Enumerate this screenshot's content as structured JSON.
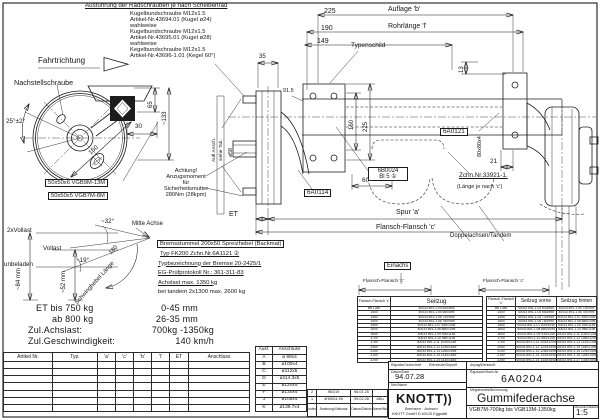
{
  "notes": {
    "title": "Ausführung der Radschrauben je nach Scheibenrad",
    "lines": [
      "Kugelbundschraube M12x1.5",
      "Artikel-Nr.43694.01 (Kugel ø24)",
      "wahlweise",
      "Kugelbundschraube M12x1.5",
      "Artikel-Nr.43695.01 (Kugel ø28)",
      "wahlweise",
      "Kegelbundschraube M12x1.5",
      "Artikel-Nr.43696-1.01 (Kegel 60°)"
    ]
  },
  "labels": {
    "fahrtrichtung": "Fahrtrichtung",
    "nachstellschraube": "Nachstellschraube",
    "typenschild": "Typenschild",
    "auflage_b": "Auflage 'b'",
    "rohrlaenge": "Rohrlänge 'l'",
    "spur": "Spur 'a'",
    "flansch_c": "Flansch-Flansch 'c'",
    "et": "ET",
    "mitte_achse": "Mitte Achse",
    "vollast2": "2xVollast",
    "vollast": "Vollast",
    "unbeladen": "unbeladen",
    "schwinghebel": "Schwinghebel Länge",
    "schwinghebel_180": "180",
    "einachs": "Einachs",
    "doppelachsen": "Doppelachsen/Tandem",
    "aufl_ansch": "Aufl.Ansch.",
    "siehe_tab": "siehe Tab.",
    "d58": "ø58",
    "profil_gross": "50x50x6 VGB9M-13M",
    "profil_klein": "50x50x5 VGB7M-8M",
    "p6a0114": "6A0114",
    "p6a0121": "6A0121",
    "p6b0024": "6B0024",
    "p6b0024_bl": "Bl 5 ①",
    "zchn": "Zchn.Nr.33921-1.",
    "laenge_c": "(Länge je nach 'c')",
    "flansch_mini": "Flansch-Flansch 'c'",
    "ach1": "Achtung!",
    "ach2": "Anzugsmoment",
    "ach3": "für",
    "ach4": "Sicherheitsmutter",
    "ach5": "280Nm (28kpm)"
  },
  "dims": {
    "a225": "225",
    "a190": "190",
    "a149": "149",
    "a35": "35",
    "a13": "13",
    "v160": "160",
    "v225": "225",
    "a915": "91.5",
    "a60": "60",
    "a21": "21",
    "p80": "80x80x4",
    "w65": "65",
    "w133": "~133",
    "w30": "30",
    "w160": "160",
    "ang25": "25°±2°",
    "ang32": "~32°",
    "ang19": "~19°",
    "h84": "~84 mm",
    "h52": "~52 mm"
  },
  "brake": {
    "l1": "Bremsstummel 200x50 Spreizhebel (Backmat)",
    "l2": "Typ FK200  Zchn.Nr.6A1121 ②",
    "l3": "Typbezeichnung der Bremse 20-2425/1",
    "l4": "EG-Prüfprotokoll Nr.: 361-311-83",
    "l5": "Achslast max. 1350 kg",
    "l6": "bei tandem 2x1300 max. 2600 kg"
  },
  "spec": {
    "l1": "ET bis 750 kg",
    "l1v": "0-45 mm",
    "l2": "ab 800 kg",
    "l2v": "26-35 mm",
    "l3": "Zul.Achslast:",
    "l3v": "700kg -1350kg",
    "l4": "Zul.Geschwindigkeit:",
    "l4v": "140 km/h"
  },
  "artikel_table": {
    "headers": [
      "Artikel Nr.",
      "Typ.",
      "'a'",
      "'c'",
      "'b'",
      "'l'",
      "ET",
      "Anschluss"
    ]
  },
  "ausf_table": {
    "h1": "Ausf.",
    "h2": "Anschluss",
    "rows": [
      [
        "A",
        "ø 98x4"
      ],
      [
        "B",
        "ø100x4"
      ],
      [
        "C",
        "ø112x5"
      ],
      [
        "D",
        "ø114.3x5"
      ],
      [
        "E",
        "ø120x5"
      ],
      [
        "F",
        "ø130x4"
      ],
      [
        "J",
        "ø108x4"
      ],
      [
        "K",
        "ø139.7x4"
      ]
    ]
  },
  "revision": {
    "r1": [
      "2",
      "96/319",
      "96.01.25",
      ""
    ],
    "r2": [
      "1",
      "4H0024-95",
      "95.02.28",
      "ABu"
    ],
    "footer": [
      "Index/Jel",
      "Änderung/Változás",
      "Datum/Dátum",
      "Name/Név"
    ]
  },
  "seilzug_single": {
    "h_flansch": "Flansch-Flansch 'c'",
    "h_seilzug": "Seilzug",
    "rows": [
      [
        "bis 1350",
        "40033 891-1.03 630/845"
      ],
      [
        "1400",
        "40033 891-1.04 680/895"
      ],
      [
        "1450",
        "40033 891-1.05 730/945"
      ],
      [
        "1500",
        "40033 891-1.06 780/995"
      ],
      [
        "1550",
        "40033 891-1.07 830/1045"
      ],
      [
        "1600",
        "40033 891-1.08 880/1095"
      ],
      [
        "1650",
        "40033 891-1.09 930/1145"
      ],
      [
        "1700",
        "40033 891-1.10 980/1195"
      ],
      [
        "1750",
        "40033 891-1.11 1030/1245"
      ],
      [
        "2050",
        "40033 891-1.12 1230/1445"
      ],
      [
        "2100",
        "40033 891-1.13 1280/1495"
      ],
      [
        "2150",
        "40033 891-1.14 1330/1545"
      ],
      [
        "2250",
        "40033 891-1.14 1430/1645"
      ]
    ]
  },
  "seilzug_tandem": {
    "h_flansch": "Flansch-Flansch 'c'",
    "h_vorne": "Seilzug vorne",
    "h_hinten": "Seilzug hinten",
    "rows": [
      [
        "bis 1350",
        "40033 891-1.03 630/845",
        "40033 891-1.05 730/945"
      ],
      [
        "1400",
        "40033 891-1.04 680/895",
        "40033 891-1.06 780/995"
      ],
      [
        "1450",
        "40033 891-1.05 730/945",
        "40033 891-1.07 830/1045"
      ],
      [
        "1500",
        "40033 891-1.06 780/995",
        "40033 891-1.08 880/1095"
      ],
      [
        "1550",
        "40033 891-1.07 830/1045",
        "40033 891-1.09 930/1145"
      ],
      [
        "1600",
        "40033 891-1.08 880/1095",
        "40033 891-1.10 980/1195"
      ],
      [
        "1650",
        "40033 891-1.09 930/1145",
        "40033 891-1.11 1030/1245"
      ],
      [
        "1700",
        "40033 891-1.10 980/1195",
        "40033 891-1.12 1080/1295"
      ],
      [
        "1750",
        "40033 891-1.11 1030/1245",
        "40033 891-1.13 1130/1345"
      ],
      [
        "2050",
        "40033 891-1.12 1230/1445",
        "40033 891-1.14 1180/1395"
      ],
      [
        "2100",
        "40033 891-1.13 1280/1495",
        "40033 891-1.15 1230/1445"
      ],
      [
        "2150",
        "40033 891-1.14 1330/1545",
        "40033 891-1.16 1280/1495"
      ],
      [
        "2250",
        "40033 891-1.14 1430/1645",
        "40033 891-1.17 1330/1545"
      ]
    ]
  },
  "title_block": {
    "drawn_label": "Rajzolta/Gezeichnet",
    "checked_label": "Ellenőrizte/Geprüft",
    "date_label": "Dátum/Date",
    "date": "94.07.28",
    "name_label": "Név/Name",
    "material_label": "Anyag/Werkstoff:",
    "drawing_no_label": "Rajzszám/Sach-Nr.",
    "drawing_no": "6A0204",
    "title_label": "Megnevezés/Benennung",
    "title": "Gummifederachse",
    "range": "VGB7M-700kg bis VGB13M-1350kg",
    "scale_label": "Méretarány/Maßstab",
    "scale": "1:5",
    "logo": "KNOTT",
    "logo_marks": "))",
    "logo_sub": "Bremsen · Achsen",
    "logo_addr": "KNOTT GmbH  D 83125  Eggstätt"
  }
}
